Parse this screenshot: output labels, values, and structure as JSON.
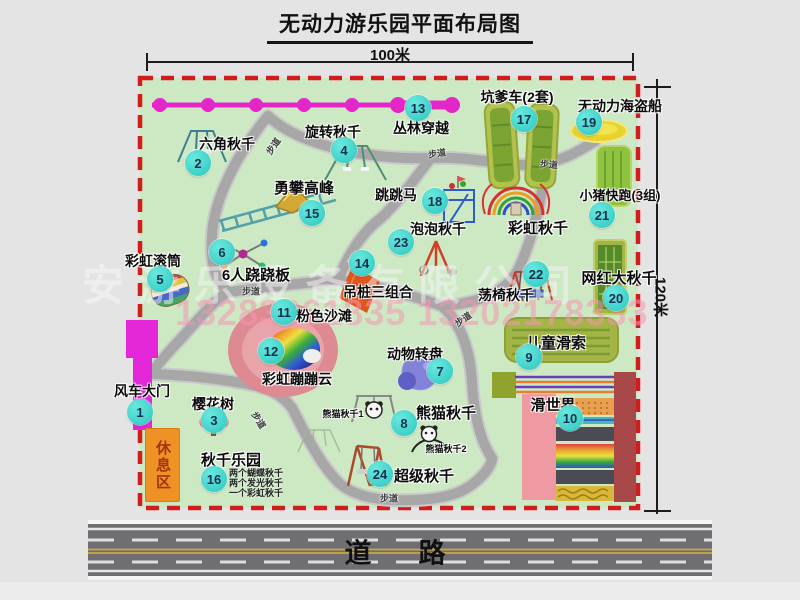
{
  "title": "无动力游乐园平面布局图",
  "scale": {
    "width_label": "100米",
    "height_label": "120米"
  },
  "road": {
    "label": "道　路"
  },
  "watermark": {
    "company": "安游乐设备有限公司",
    "phone": "13283861835 13202178333"
  },
  "map": {
    "rest_area_label": "休息区",
    "walkway_label": "步道",
    "walkways": [
      {
        "x": 273,
        "y": 146,
        "r": -55
      },
      {
        "x": 437,
        "y": 153,
        "r": -8
      },
      {
        "x": 549,
        "y": 164,
        "r": 5
      },
      {
        "x": 251,
        "y": 291,
        "r": 0
      },
      {
        "x": 259,
        "y": 420,
        "r": 58
      },
      {
        "x": 389,
        "y": 498,
        "r": 0
      },
      {
        "x": 463,
        "y": 319,
        "r": -35
      }
    ],
    "attractions": [
      {
        "num": "1",
        "label": "风车大门",
        "x": 140,
        "y": 412,
        "lx": 142,
        "ly": 381,
        "fs": 14
      },
      {
        "num": "2",
        "label": "六角秋千",
        "x": 198,
        "y": 163,
        "lx": 227,
        "ly": 134,
        "fs": 14
      },
      {
        "num": "3",
        "label": "樱花树",
        "x": 214,
        "y": 420,
        "lx": 213,
        "ly": 394,
        "fs": 14
      },
      {
        "num": "4",
        "label": "旋转秋千",
        "x": 344,
        "y": 150,
        "lx": 333,
        "ly": 122,
        "fs": 14
      },
      {
        "num": "5",
        "label": "彩虹滚筒",
        "x": 160,
        "y": 279,
        "lx": 153,
        "ly": 251,
        "fs": 14
      },
      {
        "num": "6",
        "label": "6人跷跷板",
        "x": 222,
        "y": 252,
        "lx": 256,
        "ly": 264,
        "fs": 15
      },
      {
        "num": "7",
        "label": "动物转盘",
        "x": 440,
        "y": 371,
        "lx": 415,
        "ly": 344,
        "fs": 14
      },
      {
        "num": "8",
        "label": "熊猫秋千",
        "x": 404,
        "y": 423,
        "lx": 446,
        "ly": 402,
        "fs": 15
      },
      {
        "num": "9",
        "label": "儿童滑索",
        "x": 529,
        "y": 357,
        "lx": 556,
        "ly": 332,
        "fs": 15
      },
      {
        "num": "10",
        "label": "滑世界",
        "x": 570,
        "y": 418,
        "lx": 553,
        "ly": 394,
        "fs": 15
      },
      {
        "num": "11",
        "label": "粉色沙滩",
        "x": 284,
        "y": 312,
        "lx": 324,
        "ly": 306,
        "fs": 14
      },
      {
        "num": "12",
        "label": "彩虹蹦蹦云",
        "x": 271,
        "y": 351,
        "lx": 297,
        "ly": 369,
        "fs": 14
      },
      {
        "num": "13",
        "label": "丛林穿越",
        "x": 418,
        "y": 108,
        "lx": 421,
        "ly": 118,
        "fs": 14
      },
      {
        "num": "14",
        "label": "吊桩三组合",
        "x": 362,
        "y": 263,
        "lx": 378,
        "ly": 282,
        "fs": 14
      },
      {
        "num": "15",
        "label": "勇攀高峰",
        "x": 312,
        "y": 213,
        "lx": 304,
        "ly": 177,
        "fs": 15
      },
      {
        "num": "16",
        "label": "秋千乐园",
        "x": 214,
        "y": 479,
        "lx": 231,
        "ly": 449,
        "fs": 15
      },
      {
        "num": "17",
        "label": "坑爹车(2套)",
        "x": 524,
        "y": 119,
        "lx": 517,
        "ly": 87,
        "fs": 14
      },
      {
        "num": "18",
        "label": "跳跳马",
        "x": 435,
        "y": 201,
        "lx": 396,
        "ly": 185,
        "fs": 14
      },
      {
        "num": "19",
        "label": "无动力海盗船",
        "x": 589,
        "y": 122,
        "lx": 620,
        "ly": 96,
        "fs": 14
      },
      {
        "num": "20",
        "label": "网红大秋千",
        "x": 616,
        "y": 298,
        "lx": 619,
        "ly": 267,
        "fs": 15
      },
      {
        "num": "21",
        "label": "小猪快跑(3组)",
        "x": 602,
        "y": 215,
        "lx": 620,
        "ly": 185,
        "fs": 13
      },
      {
        "num": "22",
        "label": "荡椅秋千",
        "x": 536,
        "y": 274,
        "lx": 506,
        "ly": 285,
        "fs": 14
      },
      {
        "num": "23",
        "label": "泡泡秋千",
        "x": 401,
        "y": 242,
        "lx": 438,
        "ly": 219,
        "fs": 14
      },
      {
        "num": "24",
        "label": "超级秋千",
        "x": 380,
        "y": 474,
        "lx": 424,
        "ly": 465,
        "fs": 15
      }
    ],
    "extra_labels": [
      {
        "name": "rainbow-swing-label",
        "text": "彩虹秋千",
        "x": 538,
        "y": 217,
        "fs": 15
      },
      {
        "name": "panda-swing-1-label",
        "text": "熊猫秋千1",
        "x": 343,
        "y": 407,
        "fs": 9
      },
      {
        "name": "panda-swing-2-label",
        "text": "熊猫秋千2",
        "x": 446,
        "y": 442,
        "fs": 9
      }
    ],
    "swing_park_notes": [
      "两个蝴蝶秋千",
      "两个发光秋千",
      "一个彩虹秋千"
    ]
  },
  "colors": {
    "map_bg": "#cde9c4",
    "border_red": "#d31c1c",
    "badge": "#3ad2ca",
    "magenta": "#e326c8",
    "path_gray": "#a7a7a7",
    "rest_orange": "#ef9226",
    "road_gray": "#6e6e73"
  }
}
